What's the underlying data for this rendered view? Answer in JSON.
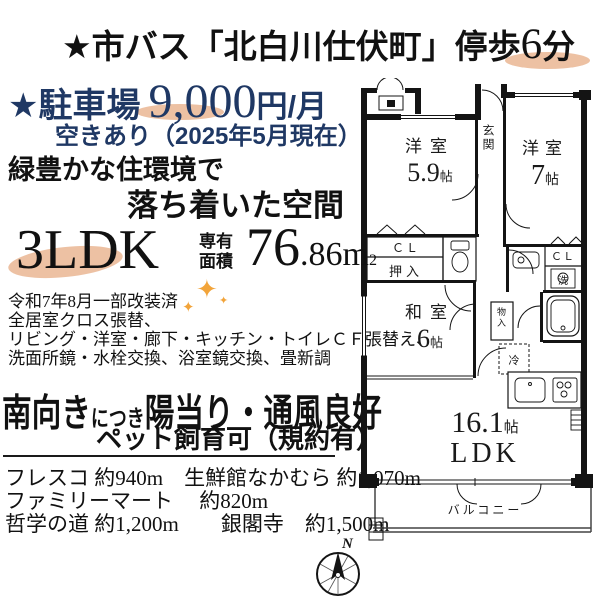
{
  "colors": {
    "navy": "#1f3864",
    "peach_highlight": "#e9b28c",
    "sparkle_gold": "#f2a43a",
    "ink": "#111111"
  },
  "header": {
    "prefix": "★市バス「北白川仕伏町」停歩",
    "walk_num": "6",
    "walk_unit": "分"
  },
  "parking": {
    "star_label": "★駐車場",
    "price": "9,000",
    "per": "円/月",
    "availability": "空きあり（2025年5月現在）"
  },
  "catch": {
    "line1": "緑豊かな住環境で",
    "line2": "落ち着いた空間"
  },
  "spec": {
    "layout": "3LDK",
    "area_label1": "専有",
    "area_label2": "面積",
    "area_int": "76",
    "area_dec": ".86",
    "area_unit": "m",
    "area_sup": "2"
  },
  "renovation": {
    "lines": [
      "令和7年8月一部改装済",
      "全居室クロス張替、",
      "リビング・洋室・廊下・キッチン・トイレＣＦ張替え、",
      "洗面所鏡・水栓交換、浴室鏡交換、畳新調"
    ]
  },
  "south": {
    "main1": "南向き",
    "sub": "につき",
    "main2": "陽当り・通風良好",
    "pet": "ペット飼育可（規約有）"
  },
  "nearby": {
    "line1": "フレスコ 約940m　生鮮館なかむら 約1,070m",
    "line2": "ファミリーマート　 約820m",
    "line3": "哲学の道 約1,200m　　銀閣寺　約1,500m"
  },
  "plan": {
    "genkan": "玄関",
    "yoshitsu1": "洋室",
    "yoshitsu1_size": "5.9",
    "yoshitsu1_tatami": "帖",
    "yoshitsu2": "洋室",
    "yoshitsu2_size": "7",
    "yoshitsu2_tatami": "帖",
    "washitsu": "和室",
    "washitsu_size": "6",
    "washitsu_tatami": "帖",
    "ldk_size": "16.1",
    "ldk_tatami": "帖",
    "ldk": "LDK",
    "cl1": "ＣＬ",
    "oshiire": "押入",
    "cl2": "ＣＬ",
    "sen": "洗",
    "mononoire": "物入",
    "rei": "冷",
    "balcony": "バルコニー"
  },
  "compass": {
    "north": "N"
  },
  "decor": {
    "sparkle": "✦"
  }
}
